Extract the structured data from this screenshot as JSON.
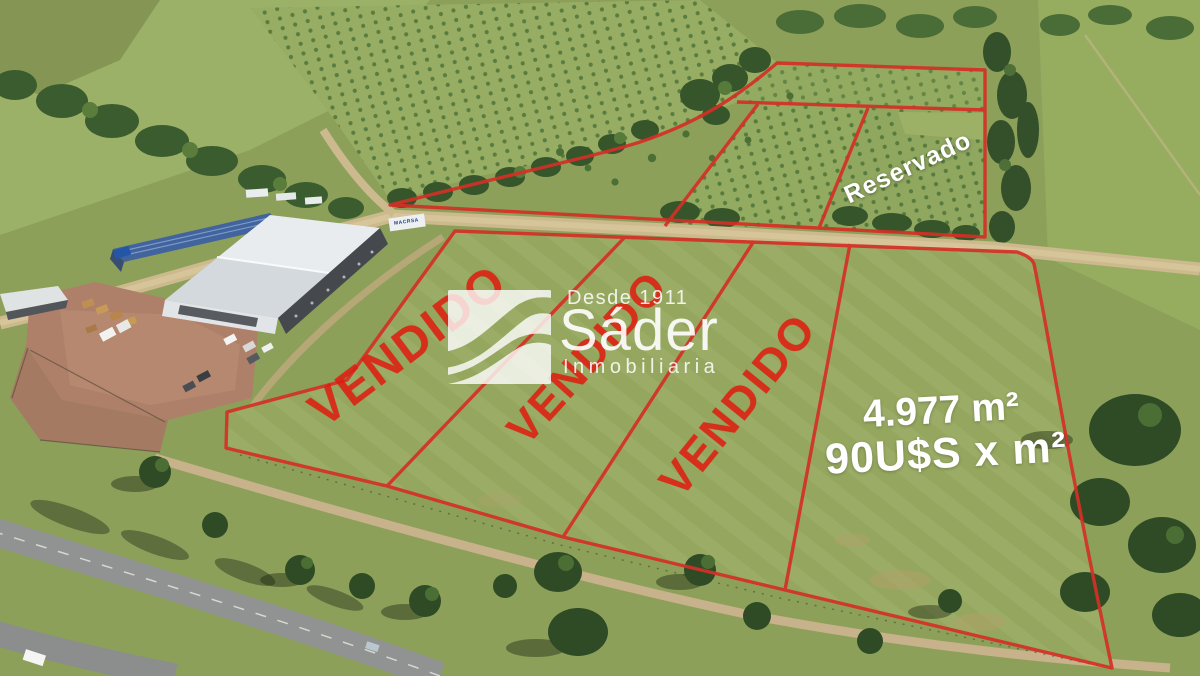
{
  "listing": {
    "sold_stamps": [
      {
        "label": "VENDIDO"
      },
      {
        "label": "VENDIDO"
      },
      {
        "label": "VENDIDO"
      }
    ],
    "reserved_stamp": "Reservado",
    "lot_area": "4.977 m²",
    "lot_price": "90U$S x m²"
  },
  "watermark": {
    "tagline": "Desde 1911",
    "name": "Sáder",
    "subtitle": "Inmobiliaria"
  },
  "scene": {
    "truck_brand": "MACRSA"
  },
  "colors": {
    "stamp_red": "#e2190e",
    "boundary_red": "#d43026",
    "stamp_white": "#ffffff",
    "grass_green": "#8ca05a",
    "dark_trees": "#33502a",
    "dirt_tan": "#cdb98e",
    "warehouse_roof_white": "#e9ecee",
    "warehouse_roof_blue": "#41639e"
  }
}
